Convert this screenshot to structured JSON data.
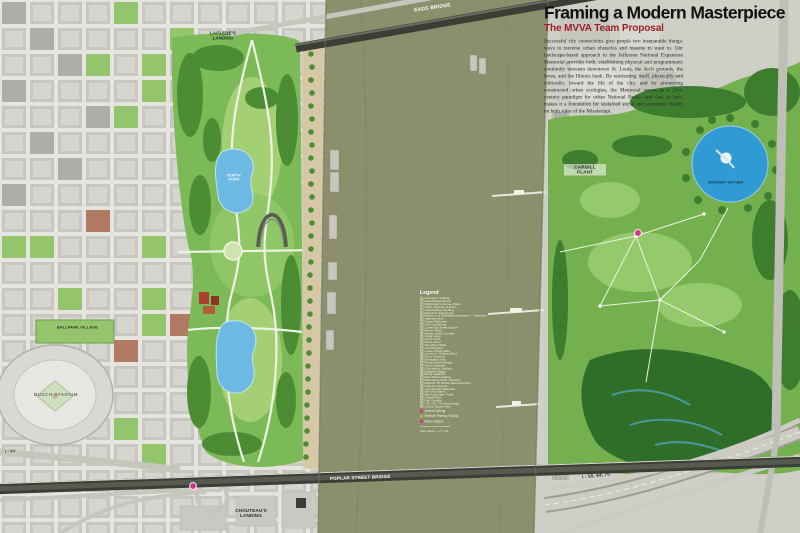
{
  "title_block": {
    "title": "Framing a Modern Masterpiece",
    "subtitle": "The MVVA Team Proposal",
    "body": "Successful city connections give people two inseparable things: ways to traverse urban obstacles and reasons to want to. Our landscape-based approach to the Jefferson National Expansion Memorial provides both, establishing physical and programmatic continuity between downtown St. Louis, the Arch grounds, the levee, and the Illinois bank. By reorienting itself, physically and culturally, toward the life of the city, and by pioneering constructed urban ecologies, the Memorial serves as a 21st-century paradigm for urban National Parks—and that, in turn, makes it a foundation for sustained social and economic vitality on both sides of the Mississippi."
  },
  "map_labels": {
    "eads_bridge": "EADS BRIDGE",
    "lacledes_landing": "LACLEDE'S\nLANDING",
    "cargill_plant": "CARGILL\nPLANT",
    "gateway_geyser": "GATEWAY GEYSER",
    "north_pond": "NORTH\nPOND",
    "busch_stadium": "BUSCH STADIUM",
    "ballpark_village": "BALLPARK VILLAGE",
    "chouteaus_landing": "CHOUTEAU'S\nLANDING",
    "poplar_street_bridge": "POPLAR STREET BRIDGE",
    "interstate_east": "I - 55, 64, 70",
    "interstate_west": "I - 64"
  },
  "legend": {
    "title": "Legend",
    "items": [
      "Laclede's Landing",
      "Eads Bridge Arrival",
      "Washington Avenue Plaza",
      "North Gateway Garden",
      "Cobblestone Landing",
      "Riverfront Esplanade",
      "Museum of Westward Expansion — Entrance",
      "Gateway Arch",
      "Grand Staircase",
      "Old Courthouse",
      "Luther Ely Smith Square",
      "Kiener Plaza",
      "Market Street Corridor",
      "Great Lawn",
      "North Pond",
      "South Pond",
      "Woodland Walk",
      "Amphitheater",
      "Levee Promenade",
      "Leonor K. Sullivan Blvd.",
      "River Overlook",
      "Municipal Dock",
      "Poplar Street Bridge",
      "South Gateway",
      "Chouteau's Landing",
      "Ballpark Village",
      "Busch Stadium",
      "East Bank Landing",
      "Mississippi River Overlook",
      "Malcolm W. Martin Memorial Park",
      "Gateway Geyser",
      "Constructed Wetlands",
      "Wet Woodland",
      "Bird Sanctuary Trails",
      "Cargill Plant",
      "Rail Corridor",
      "I-55 / 64 / 70 Interchange",
      "Casino Queen Site"
    ],
    "special_markers": [
      {
        "label": "Arrival Parking",
        "color": "#d6318e",
        "shape": "square"
      },
      {
        "label": "Remote Parking Facility",
        "color": "#8cc63f",
        "shape": "square"
      },
      {
        "label": "Metro Station",
        "color": "#d6318e",
        "shape": "circle"
      }
    ],
    "scale_note": "Max Water = +7' msl"
  },
  "colors": {
    "river": "#8b8f6c",
    "park_green": "#7cb957",
    "dark_trees": "#4c8c33",
    "pond_blue": "#6cb9e3",
    "geyser_blue": "#2f9ad3",
    "city_gray": "#cbcac4",
    "levee_tan": "#d6c8a6",
    "bridge_dark": "#3b3e37",
    "subtitle_red": "#9d2025",
    "marker_pink": "#d6318e",
    "marker_green": "#8cc63f"
  }
}
